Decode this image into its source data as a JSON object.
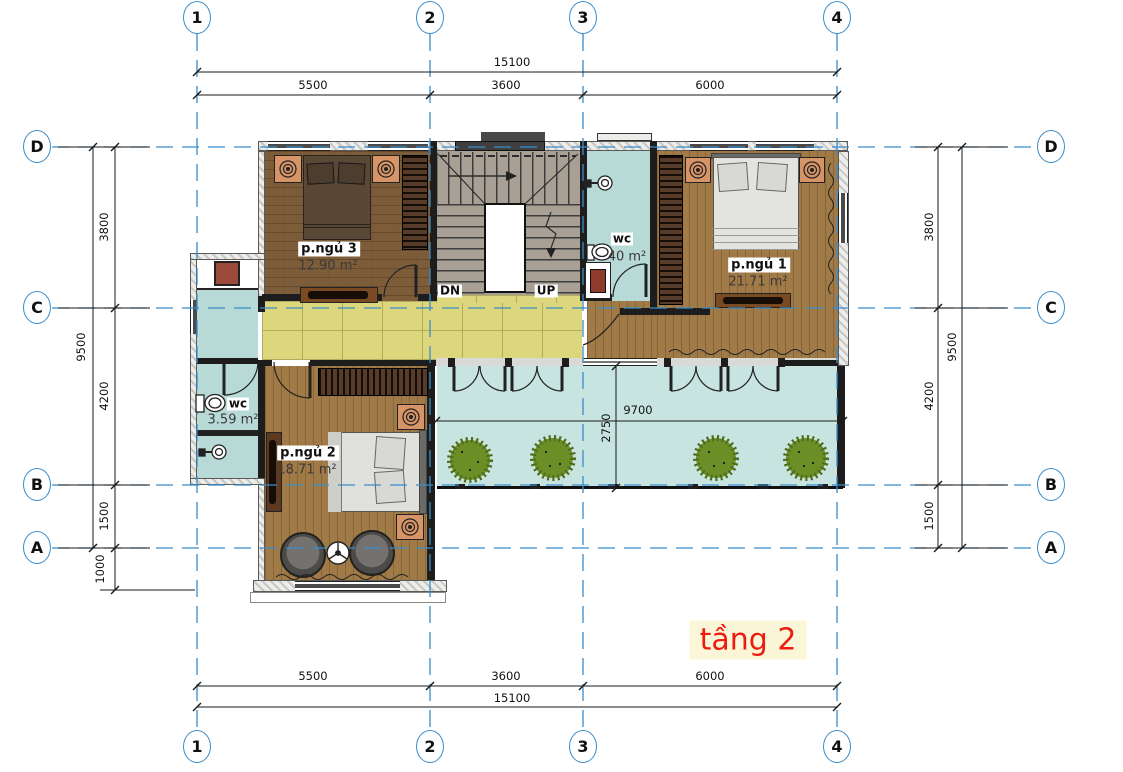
{
  "plan": {
    "title": "tầng 2",
    "grid_cols": [
      "1",
      "2",
      "3",
      "4"
    ],
    "grid_rows": [
      "D",
      "C",
      "B",
      "A"
    ],
    "dims": {
      "top_total": "15100",
      "top_segments": [
        "5500",
        "3600",
        "6000"
      ],
      "bottom_segments": [
        "5500",
        "3600",
        "6000"
      ],
      "bottom_total": "15100",
      "left_total": "9500",
      "left_segments": [
        "3800",
        "4200",
        "1500"
      ],
      "left_below": "1000",
      "right_segments": [
        "3800",
        "4200",
        "1500"
      ],
      "right_total": "9500",
      "terrace_width": "9700",
      "terrace_depth": "2750"
    },
    "rooms": {
      "bedroom3": {
        "name": "p.ngủ 3",
        "area": "12.90 m²"
      },
      "bedroom1": {
        "name": "p.ngủ 1",
        "area": "21.71 m²"
      },
      "bedroom2": {
        "name": "p.ngủ 2",
        "area": "18.71 m²"
      },
      "wc_main": {
        "name": "wc",
        "area": "40 m²"
      },
      "wc_small": {
        "name": "wc",
        "area": "3.59 m²"
      }
    },
    "stairs": {
      "down": "DN",
      "up": "UP"
    },
    "colors": {
      "grid_blue": "#3a8cc9",
      "title_red": "#ee1b10",
      "title_bg": "#fcf6d8",
      "corridor_yellow": "#dcd77d",
      "terrace_teal": "#c8e4e0",
      "wet_teal": "#b7dad6",
      "wood_light": "#a07b48",
      "wood_dark": "#7d5c3a",
      "stair_gray": "#a8a094"
    }
  }
}
